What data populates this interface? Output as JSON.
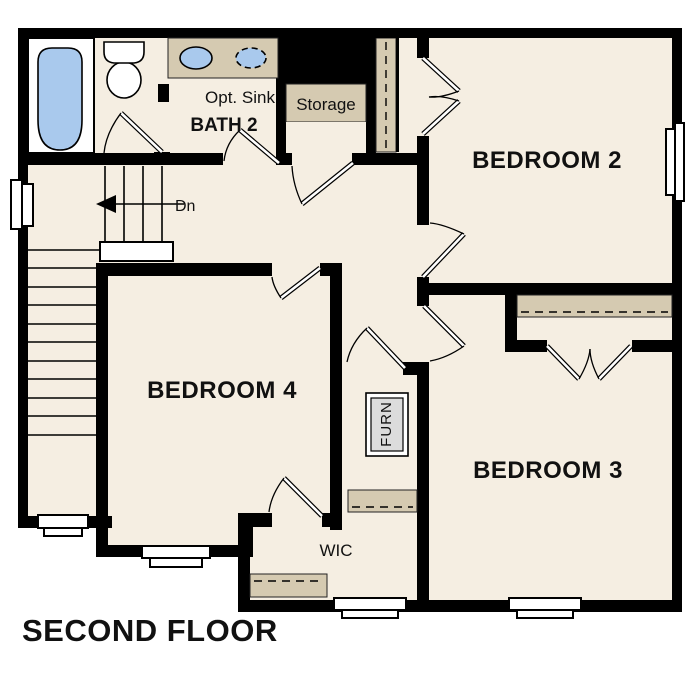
{
  "title": "SECOND FLOOR",
  "rooms": {
    "bedroom2": {
      "label": "BEDROOM 2"
    },
    "bedroom3": {
      "label": "BEDROOM 3"
    },
    "bedroom4": {
      "label": "BEDROOM 4"
    },
    "bath2": {
      "label": "BATH 2",
      "optional_sink_label": "Opt. Sink"
    },
    "storage": {
      "label": "Storage"
    },
    "wic": {
      "label": "WIC"
    },
    "furnace": {
      "label": "FURN"
    },
    "stairs": {
      "direction_label": "Dn"
    }
  },
  "colors": {
    "walls": "#000000",
    "floor": "#f5eee2",
    "shelf": "#d5cab1",
    "plumbing_blue": "#a9c9ed",
    "furnace_gray": "#dcdcdc",
    "background": "#ffffff",
    "text": "#111111"
  }
}
